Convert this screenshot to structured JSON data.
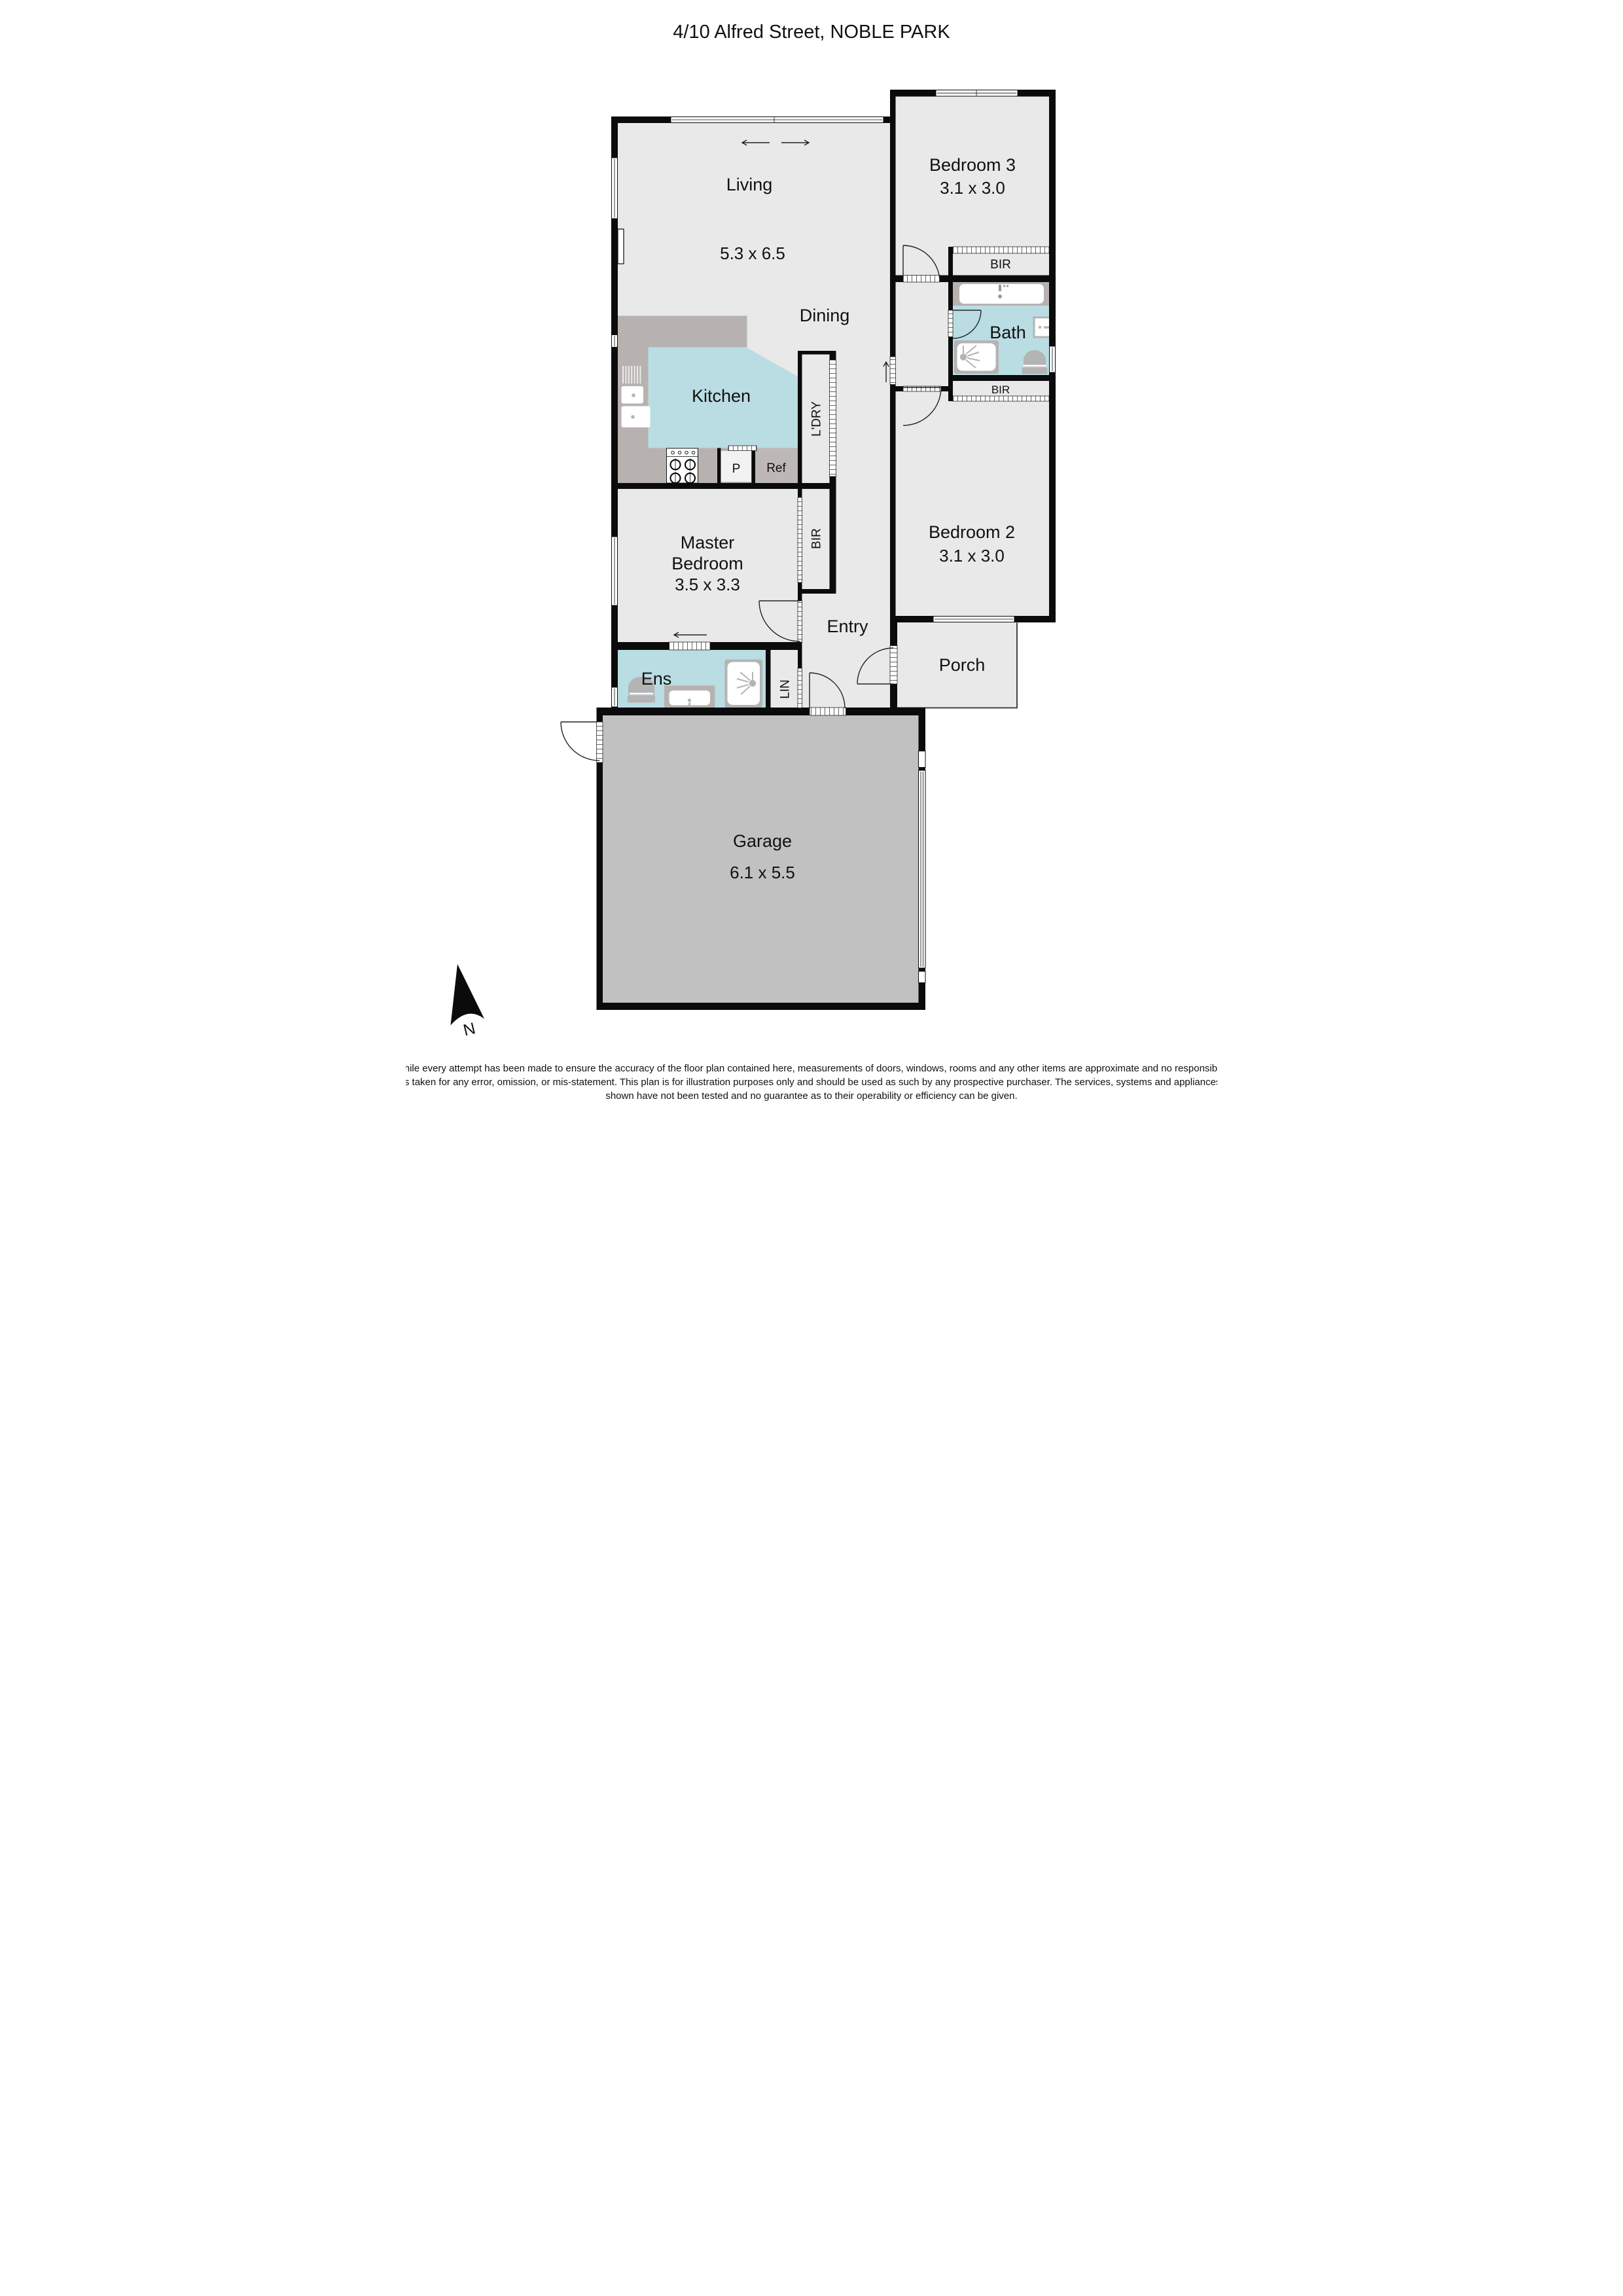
{
  "title": "4/10 Alfred Street, NOBLE PARK",
  "rooms": {
    "living": {
      "label": "Living",
      "dims": "5.3 x 6.5"
    },
    "dining": {
      "label": "Dining"
    },
    "kitchen": {
      "label": "Kitchen"
    },
    "bedroom3": {
      "label": "Bedroom 3",
      "dims": "3.1 x 3.0"
    },
    "bedroom2": {
      "label": "Bedroom 2",
      "dims": "3.1 x 3.0"
    },
    "master": {
      "label_line1": "Master",
      "label_line2": "Bedroom",
      "dims": "3.5 x 3.3"
    },
    "bath": {
      "label": "Bath"
    },
    "ens": {
      "label": "Ens"
    },
    "entry": {
      "label": "Entry"
    },
    "porch": {
      "label": "Porch"
    },
    "garage": {
      "label": "Garage",
      "dims": "6.1 x 5.5"
    }
  },
  "storage": {
    "bir_bedroom3": "BIR",
    "bir_bedroom2": "BIR",
    "bir_master": "BIR",
    "laundry": "L'DRY",
    "linen": "LIN",
    "pantry": "P",
    "fridge": "Ref"
  },
  "compass": {
    "north": "N"
  },
  "colors": {
    "wall": "#0b0b0b",
    "floor": "#e9e9e9",
    "garage_floor": "#c2c1c1",
    "bench": "#b7b2b0",
    "wet_area": "#b9dde2",
    "fixture": "#b4b4b4"
  },
  "disclaimer": {
    "line1": "\"While every attempt has been made to ensure the accuracy of the floor plan contained here, measurements of doors, windows, rooms and any other items are approximate and no responsibility",
    "line2": "is taken for any error, omission, or mis-statement. This plan is for illustration purposes only and should be used as such by any prospective purchaser. The services, systems and appliances",
    "line3": "shown have not been tested and no guarantee as to their operability or efficiency can be given."
  }
}
